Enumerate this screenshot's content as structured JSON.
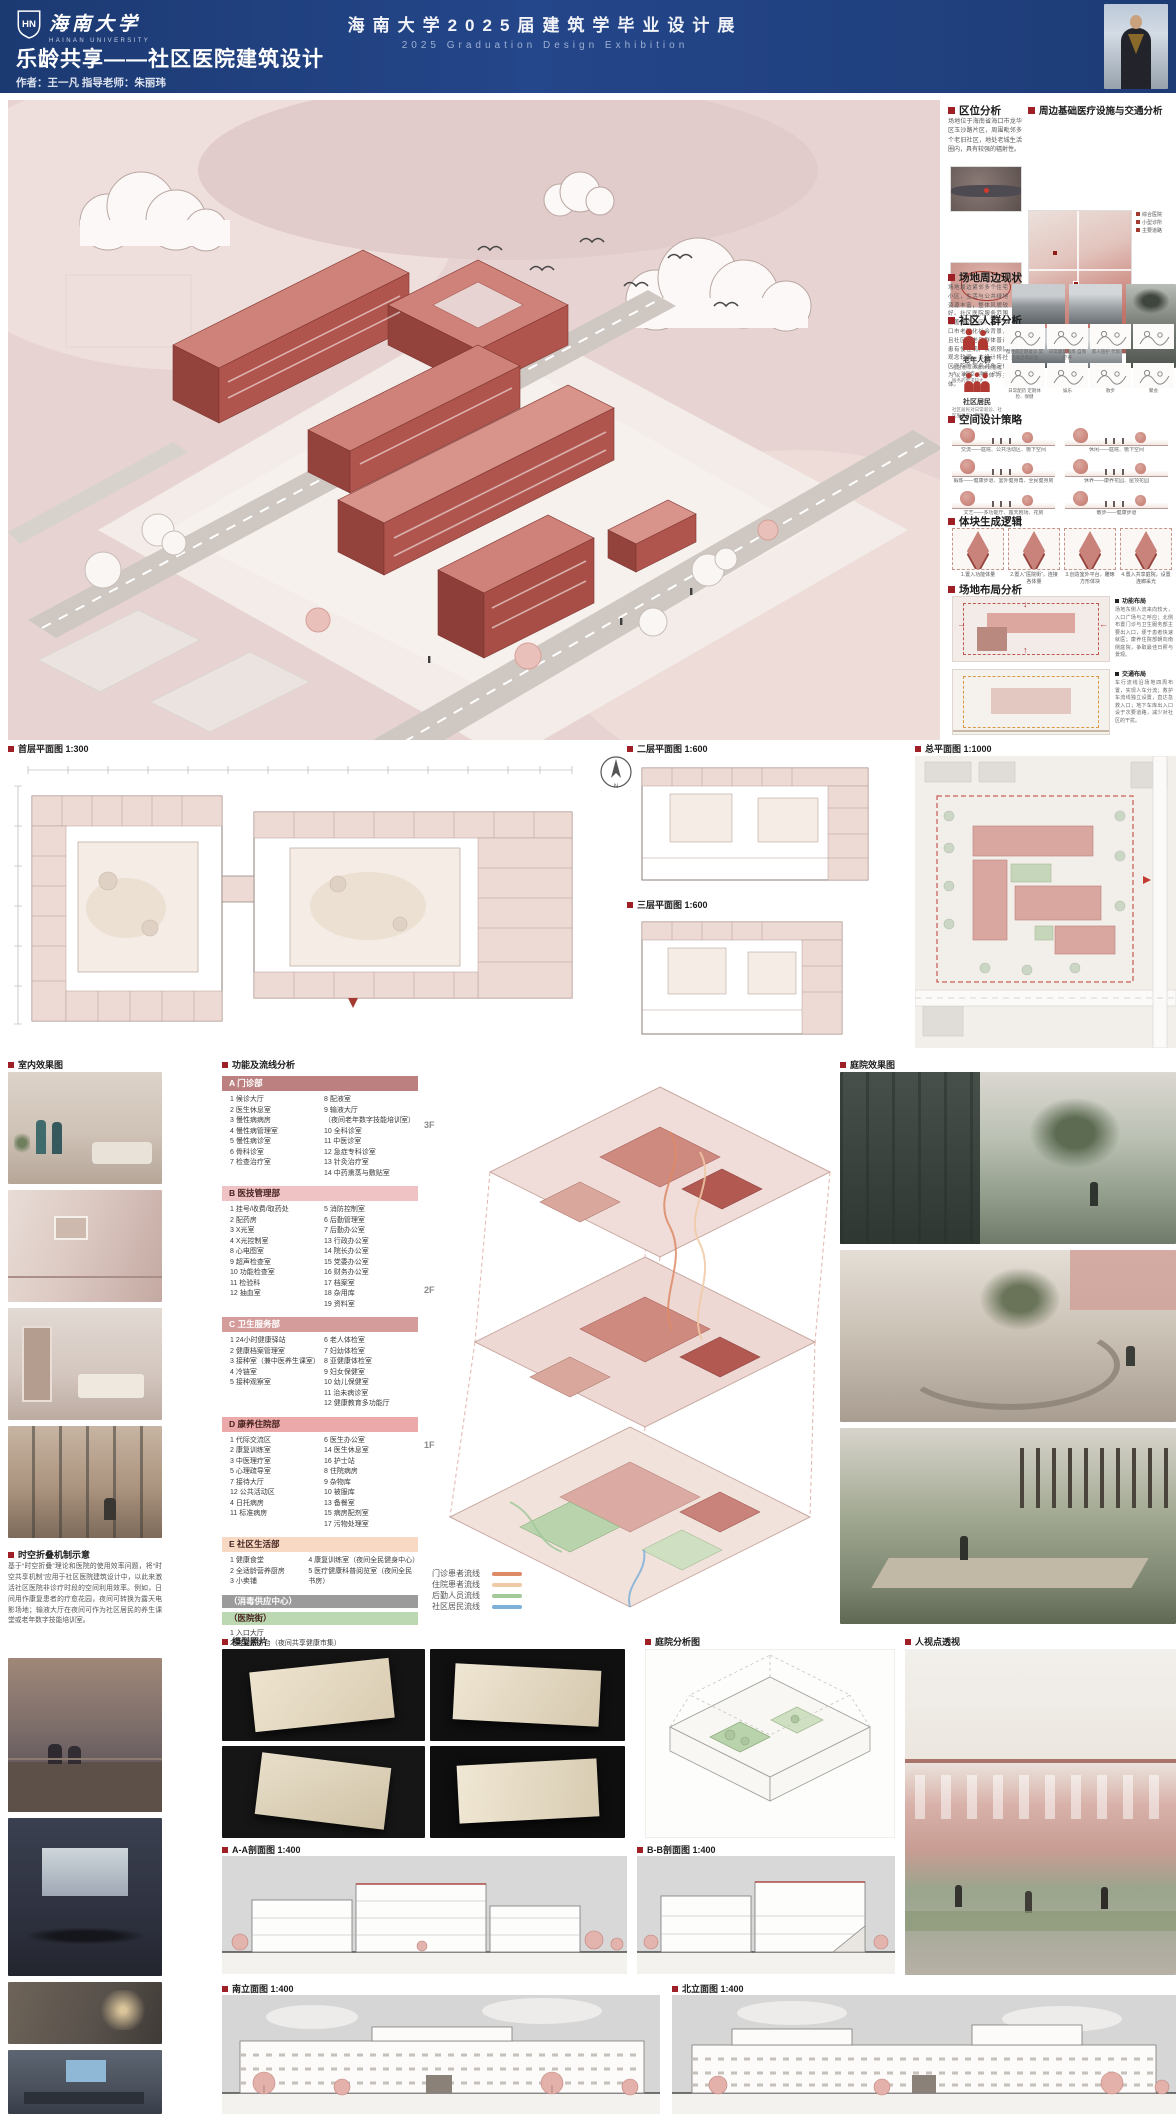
{
  "header": {
    "logo_cn": "海南大学",
    "logo_en": "HAINAN UNIVERSITY",
    "exh_cn": "海南大学2025届建筑学毕业设计展",
    "exh_en": "2025  Graduation  Design  Exhibition",
    "project_title": "乐龄共享——社区医院建筑设计",
    "author_line": "作者：王一凡  指导老师：朱丽玮"
  },
  "sidebar": {
    "loc_title": "区位分析",
    "loc_text": "场地位于海南省海口市龙华区玉沙路片区，周围毗邻多个老旧社区，地处老城生活圈内，具有较强的辐射性。",
    "med_title": "周边基础医疗设施与交通分析",
    "med_legend": [
      "综合医院",
      "小型诊所",
      "主要道路"
    ],
    "site_title": "场地周边现状",
    "site_text": "场地周边紧邻多个住宅小区，生活与公共绿地资源丰富，整体风貌较好。社区医院服务范围覆盖周边社区。基于海口市老龄化社会背景，且社区内老年群体普遍患有慢性病、疾病预防观念较弱，本设计将社区医院的服务对象定位为以老年人群体为主体。",
    "people_title": "社区人群分析",
    "group1_label": "老年人群",
    "group1_desc": "社区老年人群体数量庞大，对医疗、康养、社交服务的需求较大",
    "group2_label": "社区居民",
    "group2_desc": "社区居民对日常就诊、社区服务有一定需求",
    "vignettes": [
      "慢性病定期复诊 常见病咨询诊治",
      "日常康复锻炼 自我疗养",
      "家人陪护 代际交流",
      "融入社区生活",
      "日常配药 定期体检、保健",
      "娱乐",
      "散步",
      "聚会"
    ],
    "strategy_title": "空间设计策略",
    "strategies": [
      "交流——庭院、公共活动区、檐下空间",
      "休闲——庭院、檐下空间",
      "锻炼——健康步道、室外健身角、全民健身房",
      "休养——康养花园、屋顶花园",
      "文艺——多功能厅、露天剧场、花房",
      "散步——健康步道"
    ],
    "mass_title": "体块生成逻辑",
    "mass_steps": [
      "1.置入功能体量",
      "2.置入“医院街”，连接各体量",
      "3.创造室外平台，雕琢方形体块",
      "4.置入共享庭院，设置连廊采光"
    ],
    "layout_title": "场地布局分析",
    "layout1_label": "功能布局",
    "layout1_text": "场地东侧人流来向较大，入口广场与之呼应；北侧布置门诊与卫生服务部主要出入口，便于患者快速就医；康养住院部朝向南侧庭院，争取最佳日照与景观。",
    "layout2_label": "交通布局",
    "layout2_text": "车行流线沿场地四周布置，实现人车分流；救护车流线独立设置，直达急救入口；地下车库出入口设于次要道路，减少对社区的干扰。"
  },
  "plans": {
    "first_label": "首层平面图 1:300",
    "second_label": "二层平面图 1:600",
    "third_label": "三层平面图 1:600",
    "master_label": "总平面图 1:1000"
  },
  "renders": {
    "interior_label": "室内效果图",
    "courtyard_label": "庭院效果图",
    "eye_label": "人视点透视",
    "model_label": "模型照片",
    "analysis_label": "庭院分析图"
  },
  "concept": {
    "title": "时空折叠机制示意",
    "text": "基于“时空折叠”理论和医院的使用效率问题，将“时空共享机制”应用于社区医院建筑设计中，以此来激活社区医院非诊疗时段的空间利用效率。例如，日间用作康复患者的疗愈花园，夜间可转换为露天电影场地；输液大厅在夜间可作为社区居民的养生课堂或老年数字技能培训室。"
  },
  "function": {
    "title": "功能及流线分析",
    "a_name": "A 门诊部",
    "a_col1": [
      "1 候诊大厅",
      "2 医生休息室",
      "3 慢性病病房",
      "4 慢性病管理室",
      "5 慢性病诊室",
      "6 骨科诊室",
      "7 检查治疗室"
    ],
    "a_col2": [
      "8 配液室",
      "9 输液大厅",
      "（夜间老年数字技能培训室）",
      "10 全科诊室",
      "11 中医诊室",
      "12 急症专科诊室",
      "13 针灸治疗室",
      "14 中药熏蒸与敷贴室"
    ],
    "b_name": "B 医技管理部",
    "b_col1": [
      "1 挂号/收费/取药处",
      "2 配药房",
      "3 X光室",
      "4 X光控制室",
      "8 心电图室",
      "9 超声检查室",
      "10 功能检查室",
      "11 检验科",
      "12 抽血室"
    ],
    "b_col2": [
      "5 消防控制室",
      "6 后勤管理室",
      "7 后勤办公室",
      "13 行政办公室",
      "14 院长办公室",
      "15 党委办公室",
      "16 财务办公室",
      "17 档案室",
      "18 杂用库",
      "19 资料室"
    ],
    "c_name": "C 卫生服务部",
    "c_col1": [
      "1 24小时健康驿站",
      "2 健康档案管理室",
      "3 接种室（兼中医养生课室）",
      "4 冷链室",
      "5 接种观察室"
    ],
    "c_col2": [
      "6 老人体检室",
      "7 妇幼体检室",
      "8 亚健康体检室",
      "9 妇女保健室",
      "10 幼儿保健室",
      "11 治未病诊室",
      "12 健康教育多功能厅"
    ],
    "d_name": "D 康养住院部",
    "d_col1": [
      "1 代际交流区",
      "2 康复训练室",
      "3 中医理疗室",
      "5 心理疏导室",
      "7 接待大厅",
      "12 公共活动区",
      "4 日托病房",
      "11 标准病房"
    ],
    "d_col2": [
      "6 医生办公室",
      "14 医生休息室",
      "16 护士站",
      "8 住院病房",
      "9 杂物库",
      "10 被服库",
      "13 备餐室",
      "15 病房配剂室",
      "17 污物处理室"
    ],
    "e_name": "E 社区生活部",
    "e_col1": [
      "1 健康食堂",
      "2 全适龄营养厨房",
      "3 小卖铺"
    ],
    "e_col2": [
      "4 康复训练室（夜间全民健身中心）",
      "5 医疗健康科普阅览室（夜间全民书房）"
    ],
    "band_disinfect": "（消毒供应中心）",
    "band_street": "（医院街）",
    "street_items": [
      "1 入口大厅",
      "2 咨询服务台（夜间共享健康市集）"
    ],
    "floors": [
      "3F",
      "2F",
      "1F"
    ],
    "legend": [
      {
        "label": "门诊患者流线",
        "color": "#dd8a66"
      },
      {
        "label": "住院患者流线",
        "color": "#f0c9a6"
      },
      {
        "label": "后勤人员流线",
        "color": "#a3c99b"
      },
      {
        "label": "社区居民流线",
        "color": "#7fb0d8"
      }
    ]
  },
  "drawings": {
    "aa_label": "A-A剖面图 1:400",
    "bb_label": "B-B剖面图 1:400",
    "south_label": "南立面图 1:400",
    "north_label": "北立面图 1:400"
  }
}
